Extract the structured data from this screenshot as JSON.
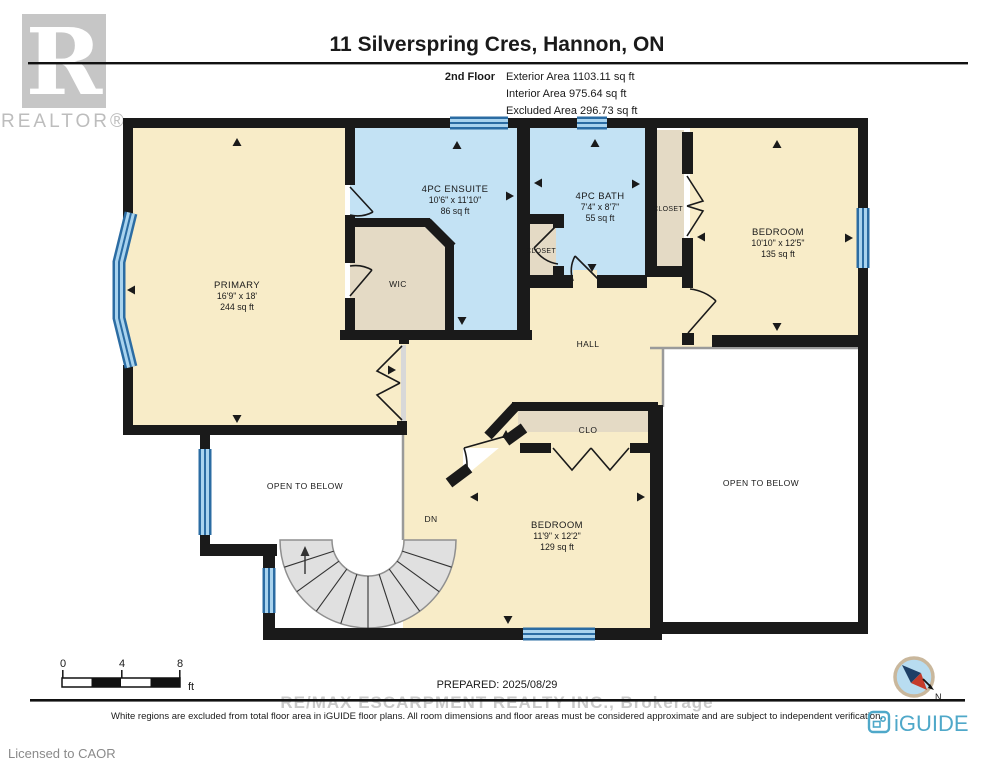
{
  "header": {
    "title": "11 Silverspring Cres, Hannon, ON",
    "floor_label": "2nd Floor",
    "exterior": "Exterior Area 1103.11 sq ft",
    "interior": "Interior Area 975.64 sq ft",
    "excluded": "Excluded Area 296.73 sq ft"
  },
  "branding": {
    "realtor_r": "R",
    "realtor_text": "REALTOR®"
  },
  "rooms": {
    "primary": {
      "name": "PRIMARY",
      "dims": "16'9\" x 18'",
      "area": "244 sq ft"
    },
    "ensuite": {
      "name": "4PC ENSUITE",
      "dims": "10'6\" x 11'10\"",
      "area": "86 sq ft"
    },
    "wic": {
      "name": "WIC"
    },
    "bath": {
      "name": "4PC BATH",
      "dims": "7'4\" x 8'7\"",
      "area": "55 sq ft"
    },
    "closet_bath": {
      "name": "CLOSET"
    },
    "closet_bedroom": {
      "name": "CLOSET"
    },
    "bedroom_right": {
      "name": "BEDROOM",
      "dims": "10'10\" x 12'5\"",
      "area": "135 sq ft"
    },
    "hall": {
      "name": "HALL"
    },
    "clo": {
      "name": "CLO"
    },
    "bedroom_bottom": {
      "name": "BEDROOM",
      "dims": "11'9\" x 12'2\"",
      "area": "129 sq ft"
    },
    "open_below_left": {
      "label": "OPEN TO BELOW"
    },
    "open_below_right": {
      "label": "OPEN TO BELOW"
    },
    "stairs": {
      "dn": "DN"
    }
  },
  "footer": {
    "scale": {
      "tick0": "0",
      "tick1": "4",
      "tick2": "8",
      "unit": "ft"
    },
    "prepared": "PREPARED: 2025/08/29",
    "watermark": "RE/MAX ESCARPMENT REALTY INC., Brokerage",
    "disclaimer": "White regions are excluded from total floor area in iGUIDE floor plans. All room dimensions and floor areas must be considered approximate and are subject to independent verification.",
    "iguide": "iGUIDE",
    "compass_n": "N",
    "licensed": "Licensed to CAOR"
  },
  "colors": {
    "wall": "#1a1a1a",
    "room_cream": "#f8ecc8",
    "room_blue": "#c3e2f4",
    "room_tan": "#e4dac5",
    "stairs_gray": "#e0e0e0",
    "window_dark": "#2b6ca3",
    "window_light": "#a9d3ee",
    "iguide_blue": "#4fa8c9",
    "compass_red": "#c43b2a",
    "compass_navy": "#1e3f66"
  }
}
